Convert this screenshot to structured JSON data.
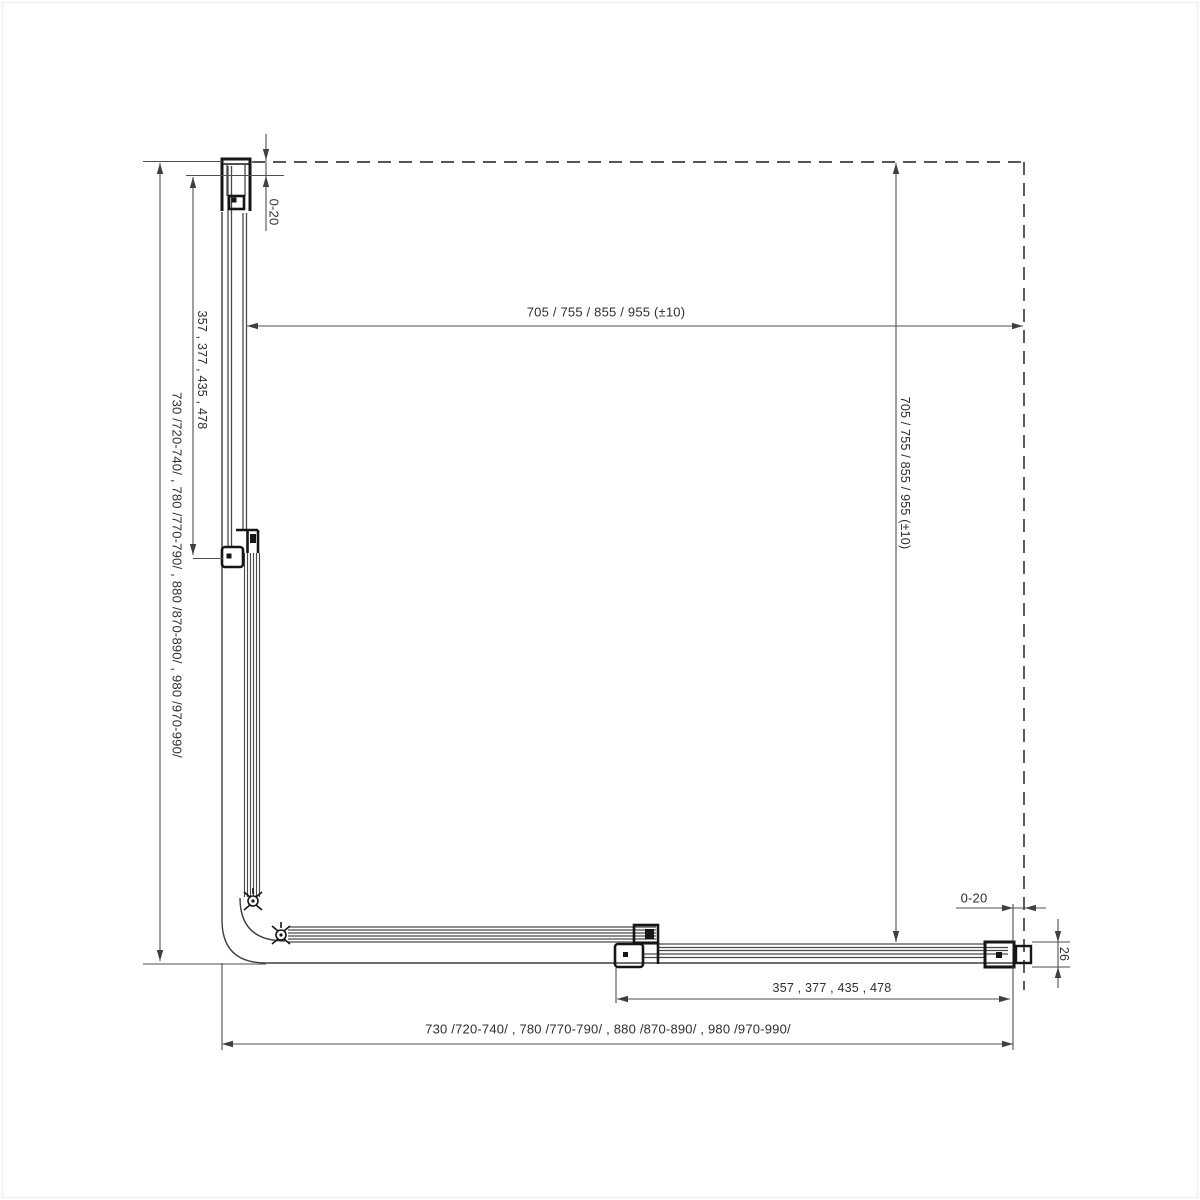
{
  "drawing": {
    "type": "technical-plan-view-shower-enclosure",
    "labels": {
      "dim_top_width": "705 / 755 / 855 / 955 (±10)",
      "dim_right_depth": "705 / 755 / 855 / 955 (±10)",
      "dim_left_overall": "730  /720-740/ , 780  /770-790/ , 880  /870-890/ , 980  /970-990/",
      "dim_left_fixed": "357 , 377 , 435 , 478",
      "dim_bottom_overall": "730  /720-740/ , 780  /770-790/ , 880  /870-890/ , 980  /970-990/",
      "dim_bottom_fixed": "357 , 377 , 435 , 478",
      "dim_wall_gap_top": "0-20",
      "dim_wall_gap_right": "0-20",
      "dim_profile_depth": "26"
    },
    "colors": {
      "line": "#4a4a4a",
      "dimension": "#4f4f4f",
      "profile": "#161616",
      "text": "#2f2f2f",
      "background": "#ffffff"
    }
  }
}
